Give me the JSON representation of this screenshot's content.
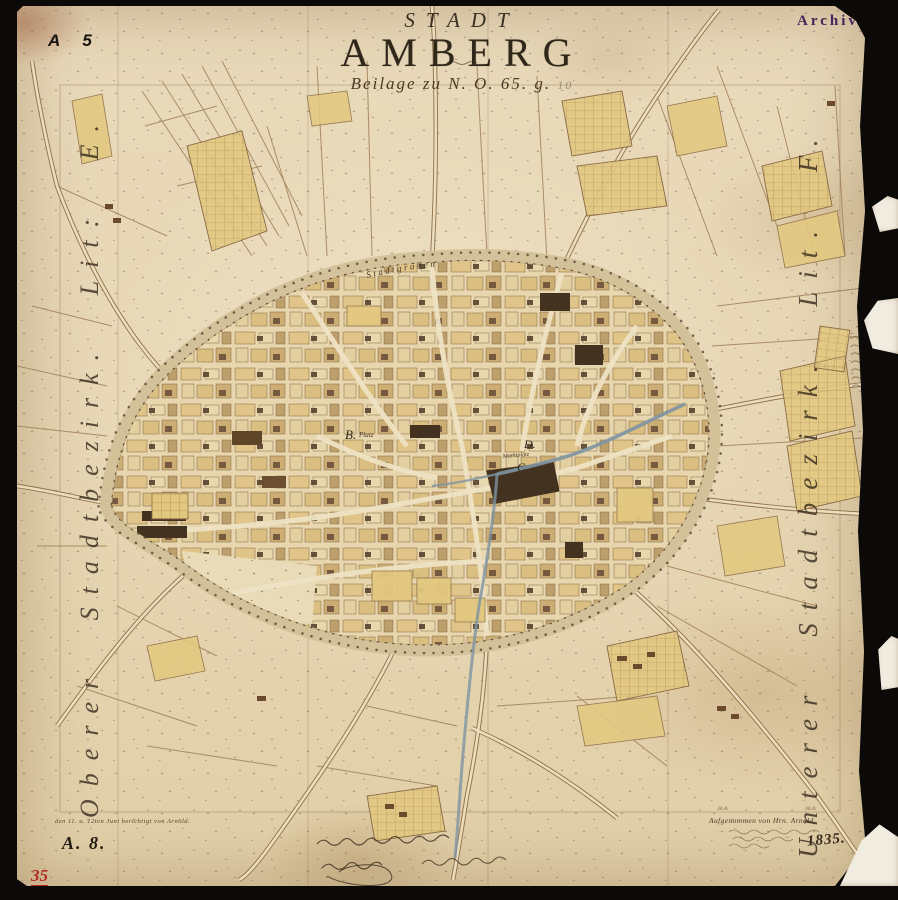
{
  "title": {
    "kicker": "STADT",
    "main": "AMBERG",
    "beilage_line": "Beilage zu N. O. 65. g.",
    "beilage_suffix": "10"
  },
  "stamps": {
    "archiv": "Archiv",
    "sheet_no": "A 5",
    "bottom_sheet_ref": "A. 8.",
    "red_inventory_no": "35"
  },
  "margins": {
    "left": "Oberer Stadtbezirk. Lit: E.",
    "right": "Unterer Stadtbezirk. Lit. F."
  },
  "map_labels": {
    "moat": "Stadtgraben",
    "district_b": "B.",
    "district_b_suffix": "Platz",
    "district_c": "C.",
    "district_d": "D.",
    "market": "Marktplatz",
    "parcel_a": "30.A.",
    "parcel_b": "30.A."
  },
  "footer": {
    "survey_credit": "Aufgenommen von Hrn. Arnold",
    "year": "1835.",
    "revision_note": "den 11. u. 12ten Juni berichtigt von Arnold."
  },
  "colors": {
    "black_margin": "#0b0a09",
    "paper": "#e7d7b6",
    "ink_brown": "#8a6a45",
    "building_yellow": "#e2c87f",
    "building_dark": "#4e3a26",
    "river_blue": "#7e94a3",
    "stamp_purple": "#46245c",
    "inventory_red": "#b22a22"
  }
}
